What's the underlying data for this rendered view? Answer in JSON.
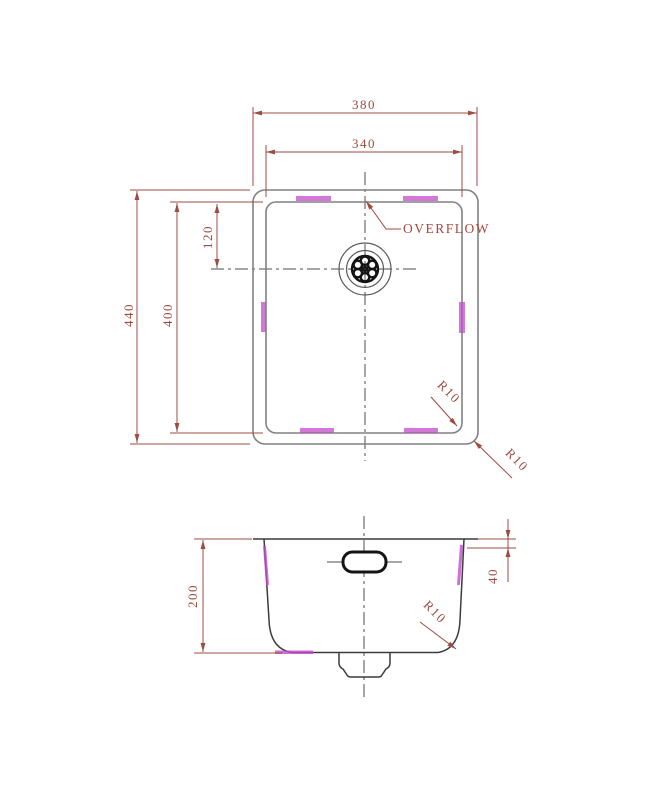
{
  "drawing": {
    "type": "technical-drawing-sink",
    "colors": {
      "dimension": "#9e4b42",
      "object_line": "#818181",
      "object_dark": "#3c3c3c",
      "heavy_line": "#141414",
      "watermark": "#c04ccc",
      "background": "#ffffff"
    },
    "top_view": {
      "dim_outer_width": "380",
      "dim_inner_width": "340",
      "dim_outer_height": "440",
      "dim_inner_height": "400",
      "dim_drain_offset": "120",
      "overflow_label": "OVERFLOW",
      "radius_inner_label": "R10",
      "radius_outer_label": "R10"
    },
    "section_view": {
      "dim_depth": "200",
      "dim_overflow_drop": "40",
      "radius_label": "R10"
    }
  }
}
